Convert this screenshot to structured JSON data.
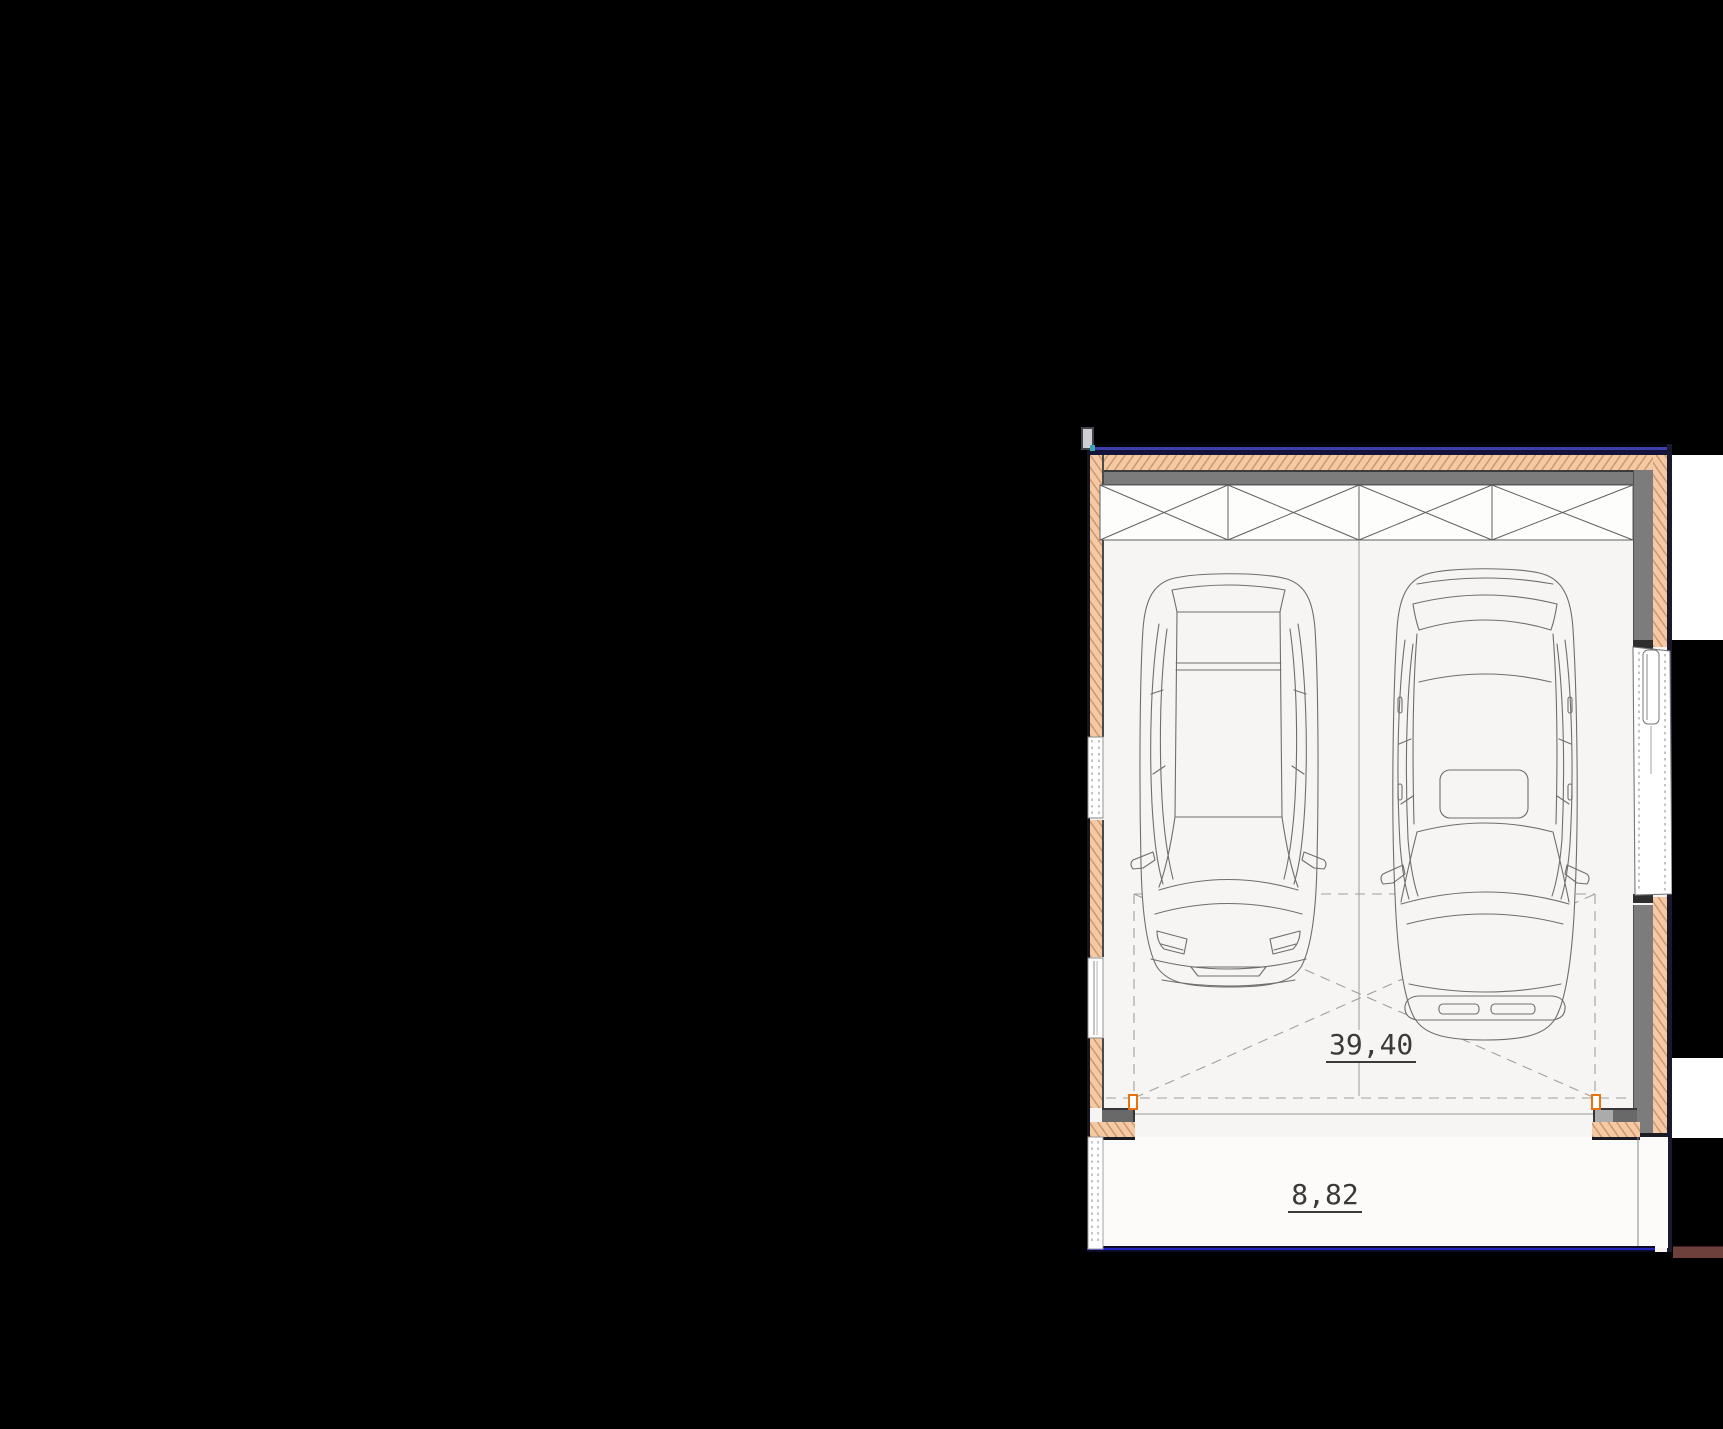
{
  "scene": {
    "type": "architectural-floor-plan",
    "description": "Plan view of a double garage with two cars parked side by side, garage door opening at bottom, side entry door on the right wall, driveway apron below"
  },
  "labels": {
    "garage_area": "39,40",
    "driveway_area": "8,82"
  },
  "colors": {
    "canvas": "#000000",
    "insulation_hatch": "#f5c9a3",
    "wall_core_gray": "#7c7c7c",
    "outline_dark": "#15151f",
    "top_edge_blue": "#3e3ea8",
    "bottom_edge_blue": "#2323c0",
    "marker_orange": "#e8730a",
    "ground_bar_brown": "#6d403b",
    "floor": "#f6f5f3",
    "driveway": "#fcfbfa",
    "drawing_line": "#6e6e6e",
    "dashed_line": "#a0a0a0",
    "text": "#3a3a3a"
  },
  "elements": [
    "top-wall",
    "left-wall",
    "right-wall",
    "lintel-x-panels",
    "window-upper",
    "window-lower",
    "side-entry-door",
    "garage-door-opening",
    "door-jamb-marker-left",
    "door-jamb-marker-right",
    "parking-area-dashed-outline",
    "car-top-view-left",
    "car-top-view-right",
    "driveway-apron",
    "boundary-fence-strip"
  ]
}
